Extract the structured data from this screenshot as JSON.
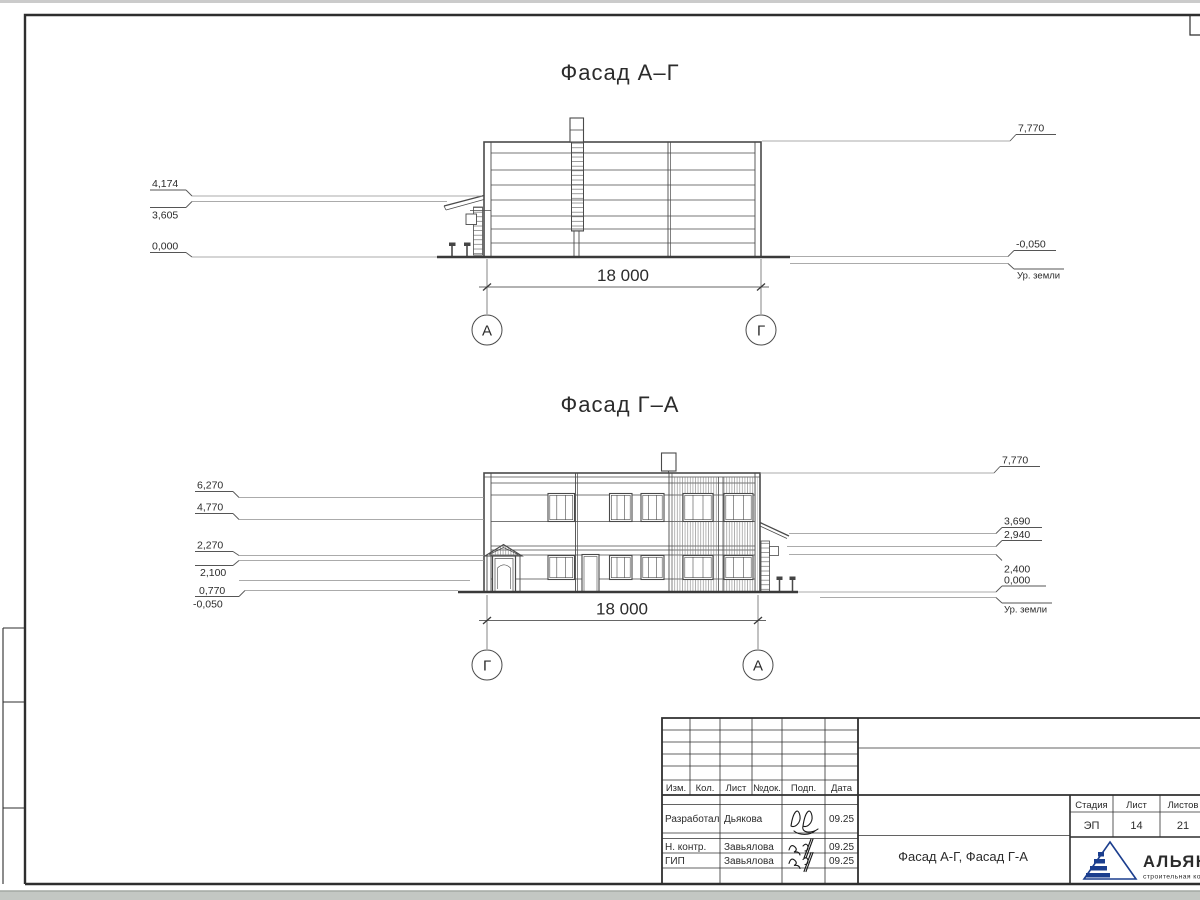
{
  "facade_ag": {
    "title": "Фасад А–Г",
    "dim_width": "18 000",
    "axis_left": "А",
    "axis_right": "Г",
    "elev_left": [
      "4,174",
      "3,605",
      "0,000"
    ],
    "elev_right": [
      "7,770",
      "-0,050"
    ],
    "ground_label": "Ур. земли"
  },
  "facade_ga": {
    "title": "Фасад Г–А",
    "dim_width": "18 000",
    "axis_left": "Г",
    "axis_right": "А",
    "elev_left": [
      "6,270",
      "4,770",
      "2,270",
      "2,100",
      "0,770",
      "-0,050"
    ],
    "elev_right": [
      "7,770",
      "3,690",
      "2,940",
      "2,400",
      "0,000"
    ],
    "ground_label": "Ур. земли"
  },
  "title_block": {
    "rev_header": [
      "Изм.",
      "Кол.",
      "Лист",
      "№док.",
      "Подп.",
      "Дата"
    ],
    "staff_rows": [
      {
        "role": "Разработал",
        "name": "Дьякова",
        "date": "09.25"
      },
      {
        "role": "Н. контр.",
        "name": "Завьялова",
        "date": "09.25"
      },
      {
        "role": "ГИП",
        "name": "Завьялова",
        "date": "09.25"
      }
    ],
    "doc_title": "Фасад А-Г, Фасад Г-А",
    "stage_label": "Стадия",
    "sheet_label": "Лист",
    "sheets_label": "Листов",
    "stage_value": "ЭП",
    "sheet_value": "14",
    "sheets_value": "21",
    "company_name": "АЛЬЯНС",
    "company_subtitle": "строительная компания",
    "brand_color": "#1b3e8e"
  }
}
